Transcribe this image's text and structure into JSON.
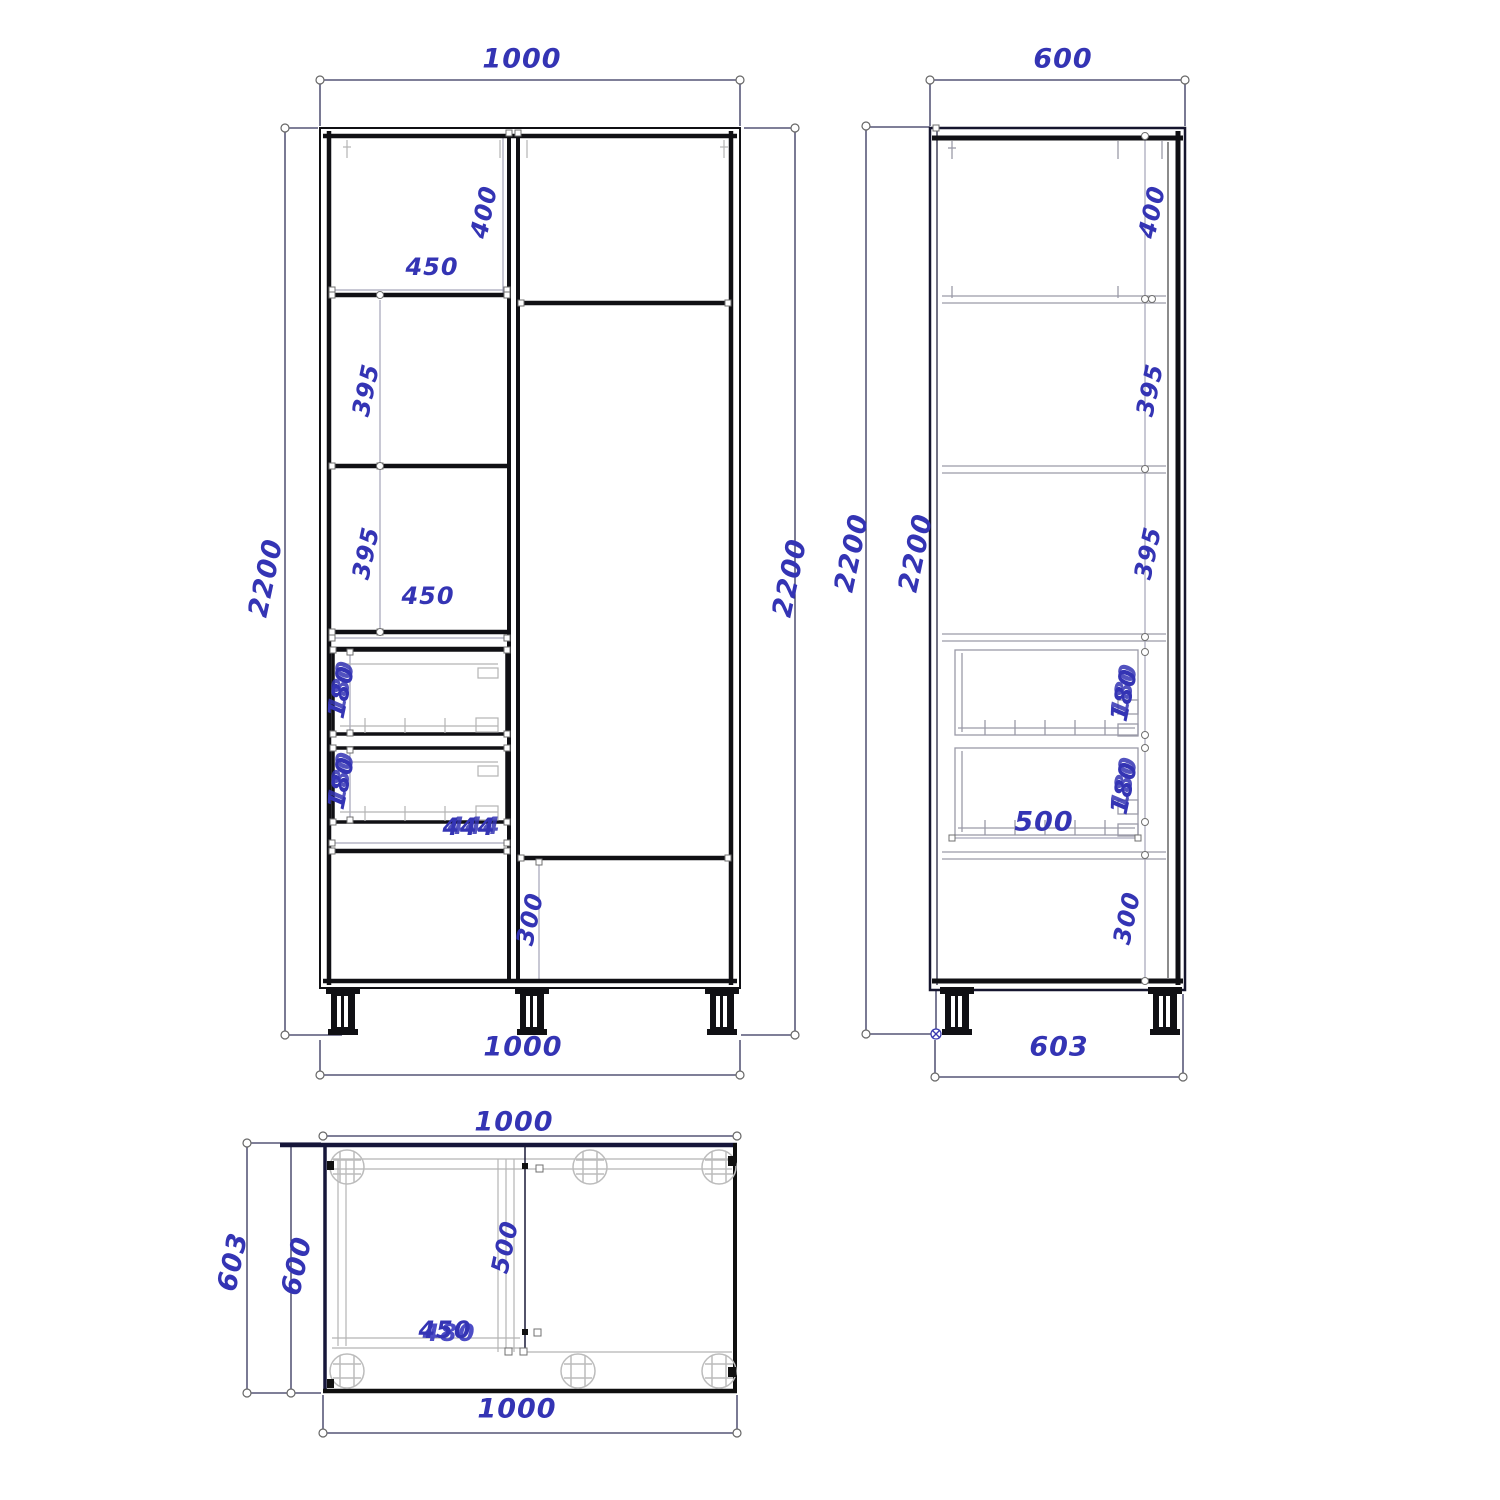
{
  "drawing": {
    "kind": "cabinet-technical-drawing",
    "unit": "mm",
    "accent_color": "#3434b4",
    "line_color": "#111118",
    "dim_line_color": "#33335a"
  },
  "views": {
    "front": {
      "width_top": "1000",
      "width_bottom": "1000",
      "height_left": "2200",
      "height_right": "2200",
      "top_shelf_height": "400",
      "top_shelf_width": "450",
      "shelf1_height": "395",
      "shelf2_height": "395",
      "shelf_width": "450",
      "drawer1_height": "180",
      "drawer2_height": "180",
      "drawer_width": "444",
      "bottom_height": "300"
    },
    "side": {
      "width_top": "600",
      "height_outer": "2200",
      "height_inner": "2200",
      "top_shelf_height": "400",
      "shelf1_height": "395",
      "shelf2_height": "395",
      "drawer1_height": "180",
      "drawer2_height": "180",
      "drawer_depth": "500",
      "bottom_height": "300",
      "width_bottom": "603"
    },
    "top": {
      "width_top": "1000",
      "width_bottom": "1000",
      "depth_outer": "603",
      "depth_inner": "600",
      "interior_depth": "500",
      "interior_width": "450",
      "interior_width_overprint": "480"
    }
  }
}
